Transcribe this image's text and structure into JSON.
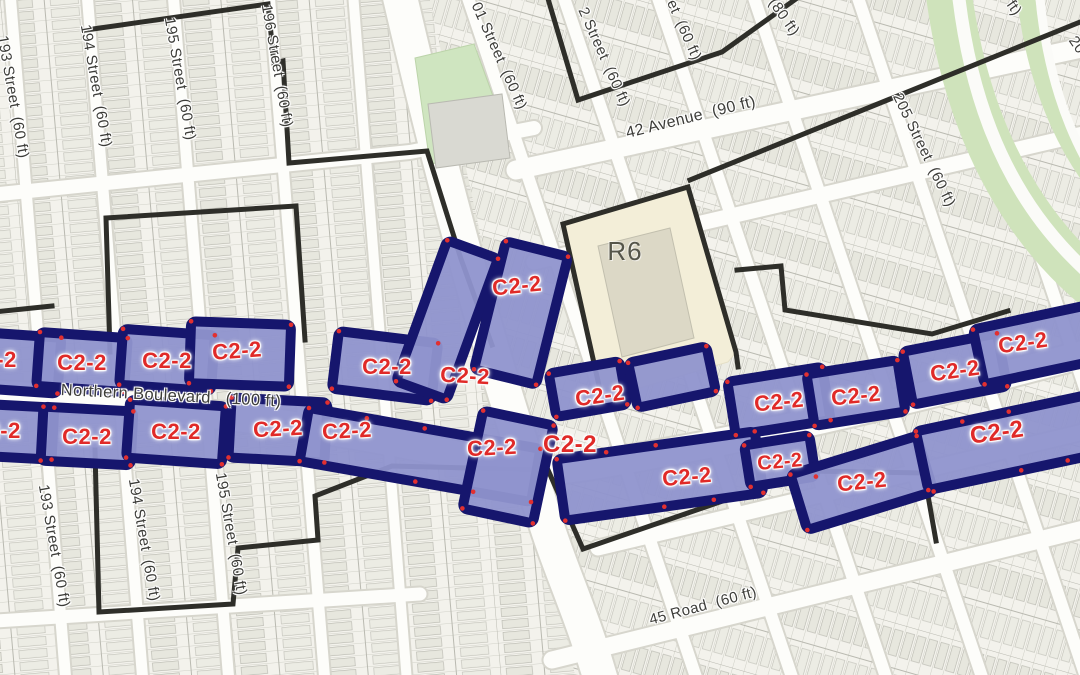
{
  "zoning": {
    "overlay_label": "C2-2",
    "residential_district_label": "R6",
    "colors": {
      "overlay_fill": "#8f94ce",
      "overlay_border": "#16166d",
      "overlay_text": "#e02a28",
      "district_boundary": "#2e2e29",
      "r6_fill": "#f3eed8",
      "park_fill": "#cfe5c0",
      "road_fill": "#fdfdfa"
    }
  },
  "r6_zone": {
    "text": "R6",
    "x": 625,
    "y": 251
  },
  "street_labels": [
    {
      "text": "193 Street  (60 ft)",
      "x": 13,
      "y": 97,
      "rot": 80
    },
    {
      "text": "194 Street  (60 ft)",
      "x": 96,
      "y": 86,
      "rot": 80
    },
    {
      "text": "195 Street  (60 ft)",
      "x": 180,
      "y": 79,
      "rot": 80
    },
    {
      "text": "196 Street  (60 ft)",
      "x": 277,
      "y": 66,
      "rot": 80
    },
    {
      "text": "01 Street  (60 ft)",
      "x": 499,
      "y": 56,
      "rot": 66
    },
    {
      "text": "2 Street  (60 ft)",
      "x": 604,
      "y": 57,
      "rot": 66
    },
    {
      "text": "et  (60 ft)",
      "x": 684,
      "y": 30,
      "rot": 66
    },
    {
      "text": "(80 ft)",
      "x": 784,
      "y": 17,
      "rot": 55
    },
    {
      "text": "ft)",
      "x": 1014,
      "y": 8,
      "rot": 55
    },
    {
      "text": "20",
      "x": 1077,
      "y": 45,
      "rot": 55
    },
    {
      "text": "205 Street  (60 ft)",
      "x": 924,
      "y": 150,
      "rot": 64
    },
    {
      "text": "42 Avenue  (90 ft)",
      "x": 691,
      "y": 118,
      "rot": -14,
      "size": 16
    },
    {
      "text": "Northern Boulevard   (100 ft)",
      "x": 171,
      "y": 396,
      "rot": 3,
      "size": 16.5
    },
    {
      "text": "45 Road  (60 ft)",
      "x": 703,
      "y": 606,
      "rot": -15
    },
    {
      "text": "193 Street  (60 ft)",
      "x": 54,
      "y": 546,
      "rot": 80
    },
    {
      "text": "194 Street  (60 ft)",
      "x": 144,
      "y": 540,
      "rot": 80
    },
    {
      "text": "195 Street  (60 ft)",
      "x": 231,
      "y": 534,
      "rot": 80
    }
  ],
  "c2_overlay": {
    "label": "C2-2",
    "instances": [
      {
        "x": -8,
        "y": 360,
        "rot": 0
      },
      {
        "x": 82,
        "y": 363,
        "rot": 0
      },
      {
        "x": 167,
        "y": 361,
        "rot": 0
      },
      {
        "x": 237,
        "y": 351,
        "rot": -4
      },
      {
        "x": 387,
        "y": 367,
        "rot": 0
      },
      {
        "x": 465,
        "y": 376,
        "rot": 3
      },
      {
        "x": 517,
        "y": 286,
        "rot": -6
      },
      {
        "x": 600,
        "y": 396,
        "rot": -8
      },
      {
        "x": 779,
        "y": 402,
        "rot": -6
      },
      {
        "x": 856,
        "y": 396,
        "rot": -6
      },
      {
        "x": 955,
        "y": 371,
        "rot": -8
      },
      {
        "x": 1023,
        "y": 343,
        "rot": -8
      },
      {
        "x": -4,
        "y": 431,
        "rot": 0
      },
      {
        "x": 87,
        "y": 437,
        "rot": 0
      },
      {
        "x": 176,
        "y": 432,
        "rot": 0
      },
      {
        "x": 278,
        "y": 429,
        "rot": -3
      },
      {
        "x": 347,
        "y": 431,
        "rot": -3
      },
      {
        "x": 492,
        "y": 448,
        "rot": -3
      },
      {
        "x": 570,
        "y": 445,
        "rot": 0,
        "size": 24
      },
      {
        "x": 687,
        "y": 477,
        "rot": -5
      },
      {
        "x": 780,
        "y": 462,
        "rot": -5,
        "size": 20
      },
      {
        "x": 862,
        "y": 482,
        "rot": -6
      },
      {
        "x": 997,
        "y": 433,
        "rot": -8,
        "size": 24
      }
    ]
  }
}
